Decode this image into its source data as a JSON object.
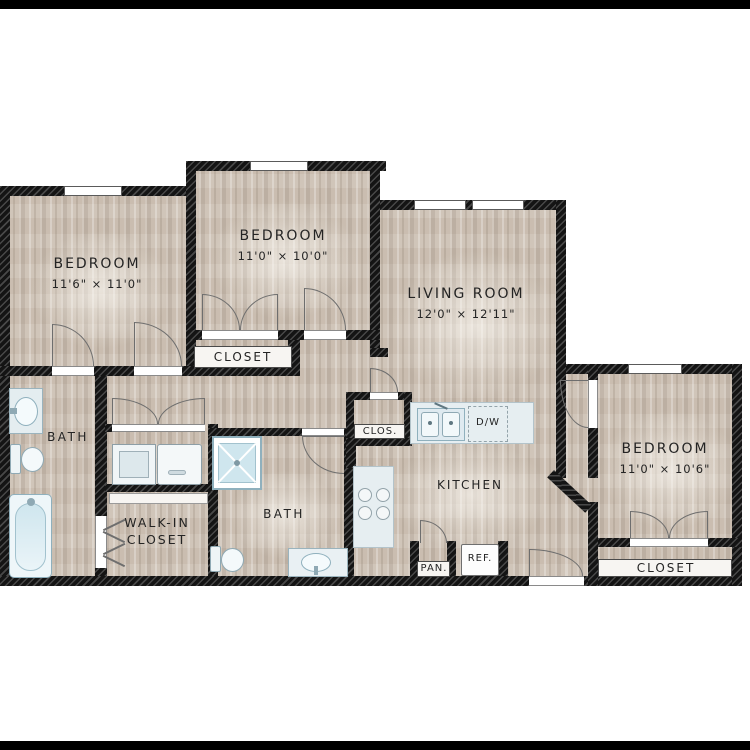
{
  "plan_title": "3 Bed 2 Bath Floor Plan",
  "rooms": {
    "bedroom1": {
      "name": "BEDROOM",
      "dims": "11'6\" × 11'0\""
    },
    "bedroom2": {
      "name": "BEDROOM",
      "dims": "11'0\" × 10'0\""
    },
    "living": {
      "name": "LIVING ROOM",
      "dims": "12'0\" × 12'11\""
    },
    "bedroom3": {
      "name": "BEDROOM",
      "dims": "11'0\" × 10'6\""
    },
    "kitchen": {
      "name": "KITCHEN"
    },
    "bath1": {
      "name": "BATH"
    },
    "bath2": {
      "name": "BATH"
    },
    "walkin": {
      "line1": "WALK-IN",
      "line2": "CLOSET"
    },
    "closet2": {
      "name": "CLOSET"
    },
    "closet3": {
      "name": "CLOSET"
    },
    "clos": {
      "name": "CLOS."
    },
    "pantry": {
      "name": "PAN."
    },
    "fridge": {
      "name": "REF."
    },
    "dishwasher": {
      "name": "D/W"
    }
  },
  "colors": {
    "floor": "#cec2b5",
    "wall": "#141414",
    "fixture_fill": "#d3e7ee",
    "fixture_outline": "#8fb0bd",
    "counter": "#e6eef1",
    "text": "#242424"
  }
}
